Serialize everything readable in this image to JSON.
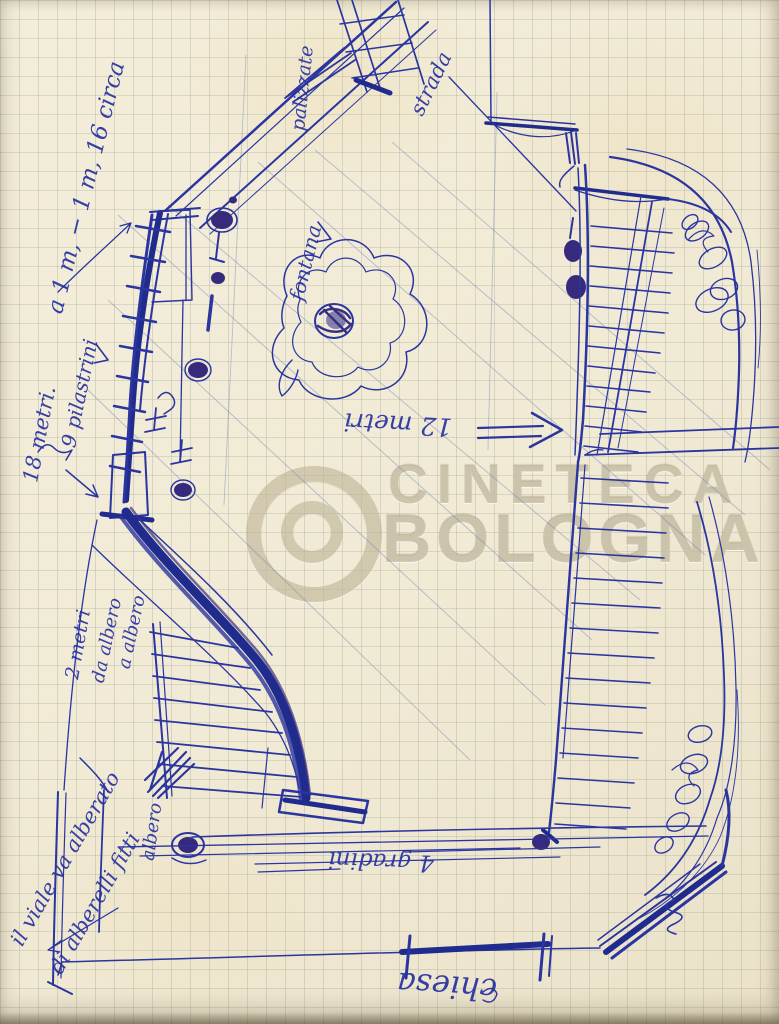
{
  "colors": {
    "ink": "#2a35a0",
    "ink_heavy": "#202b8e",
    "ink_dark_blob": "#352a7c",
    "paper": "#f1ead6",
    "grid": "#9ca592",
    "watermark": "#c1b798"
  },
  "watermark": {
    "logo_icon": "concentric-rings-logo",
    "line1": "CINETECA",
    "line2": "BOLOGNA"
  },
  "annotations": {
    "top_left_note": "a 1 m, − 1 m, 16 circa",
    "meters_18": "18 metri.",
    "pilasters": "9 pilastrini",
    "palisade": "palizzate",
    "road": "strada",
    "fountain": "fontana",
    "meters_12": "12 metri",
    "meters_2": "2 metri",
    "tree_spacing_from": "da albero",
    "tree_spacing_to": "a albero",
    "margin_note_1": "il viale va alberato",
    "margin_note_2": "di alberelli fitti",
    "tree": "albero",
    "steps_4": "4 gradini",
    "church": "chiesa"
  }
}
